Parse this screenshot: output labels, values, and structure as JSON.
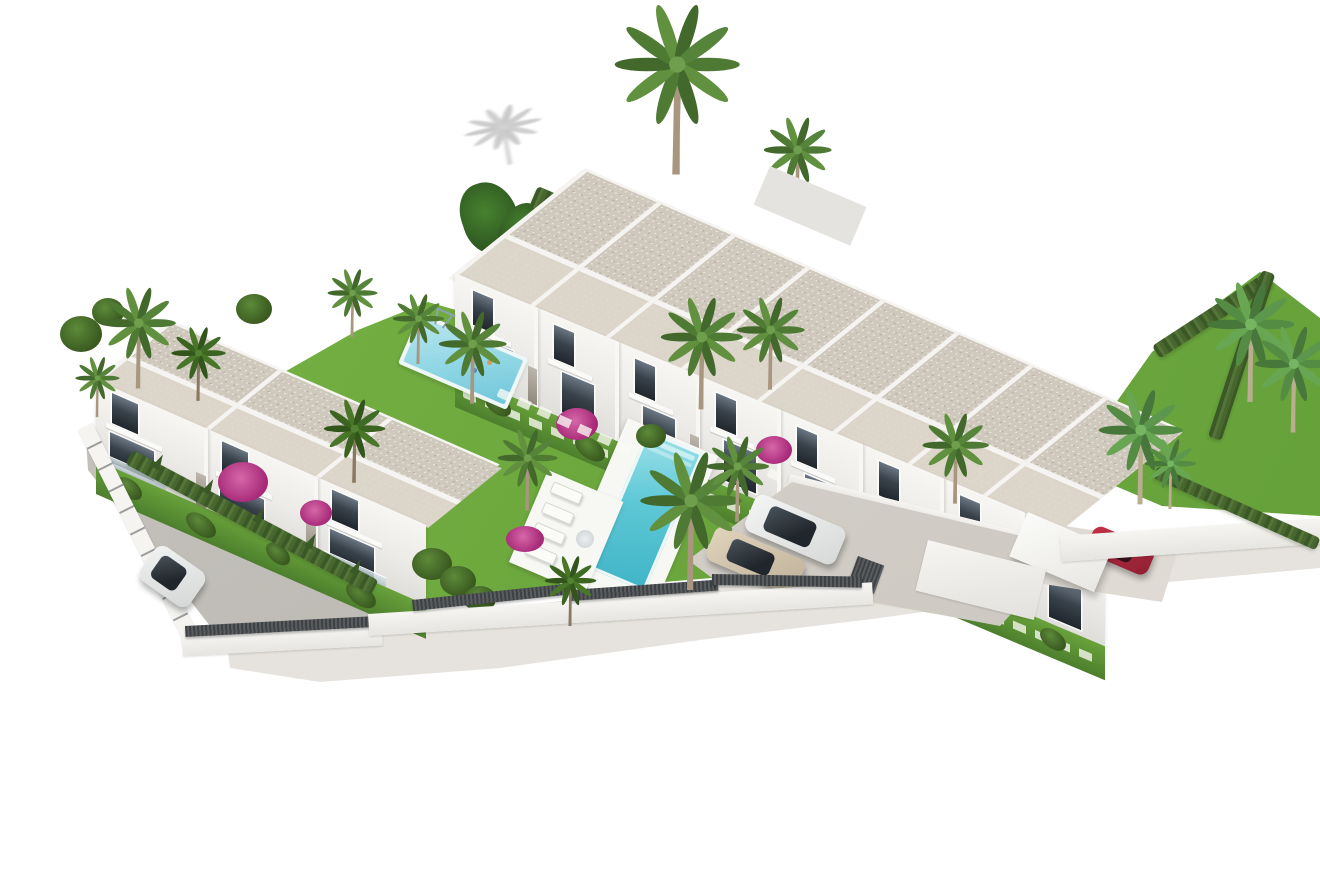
{
  "scene": {
    "description": "Aerial 3D architectural rendering of a modern white townhouse development with two swimming pools, gardens, palm trees, perimeter walls and parking on a white background",
    "background": "#ffffff"
  },
  "palette": {
    "roof_gravel": "#cfc8bc",
    "roof_front": "#ded7cc",
    "parapet_white": "#f5f4f1",
    "facade_white": "#f2f1ee",
    "window_glass": "#2e343b",
    "grass": "#74b03f",
    "grass_dark": "#5f9a35",
    "hedge_green": "#47662e",
    "pool_water": "#5ec8d6",
    "pool_water_light": "#9fe2ea",
    "kids_pool": "#8fd6e4",
    "parking_paving": "#d7d3cc",
    "road_gravel": "#c2bfb9",
    "perimeter_wall": "#f4f3f0",
    "fence_dark": "#4b4f51",
    "car_white": "#eef0ef",
    "car_beige": "#d6c9b2",
    "car_red": "#b8273f",
    "bougainvillea": "#c23a8c",
    "palm_frond": "#557e36",
    "palm_trunk": "#a8977e"
  },
  "site": {
    "main_terrace_row_units": 8,
    "left_block_units": 3,
    "floors_per_unit": 2,
    "pools": [
      "main-pool",
      "small-pool"
    ],
    "cars_visible": [
      "white-suv-parking",
      "beige-sedan-parking",
      "red-car-carport",
      "white-car-road"
    ],
    "palm_trees_visible": 16
  }
}
